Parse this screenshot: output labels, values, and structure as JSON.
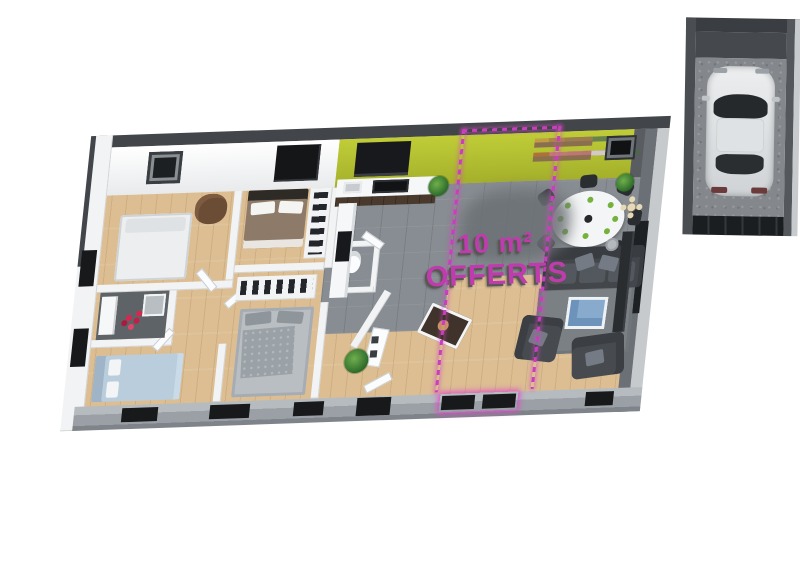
{
  "scene": {
    "description": "3D isometric floor plan render of a single-storey house with attached garage",
    "promo": {
      "line1": "10 m²",
      "line2": "OFFERTS"
    },
    "palette": {
      "background": "#ffffff",
      "accent_magenta": "#c23cb0",
      "feature_wall_green": "#aebd3a",
      "wood_floor": "#dcbe92",
      "tile_floor": "#878d92",
      "wall_dark": "#42464a",
      "wall_white": "#f2f3f4",
      "sofa_gray": "#474b50",
      "coffee_table_blue": "#87aacd"
    },
    "objects": [
      "double-bed-white",
      "double-bed-brown",
      "double-bed-gray",
      "double-bed-blue",
      "armchair-brown",
      "wardrobe-clothes",
      "bathroom-red-petals",
      "kitchen-counter",
      "kitchen-island",
      "dining-table-round",
      "dining-chairs",
      "wall-shelves",
      "picture-frames",
      "sofa",
      "living-armchairs",
      "coffee-table",
      "rug",
      "floor-lamp",
      "potted-plants",
      "car-top-view",
      "garage-door",
      "windows",
      "offer-zone-dashed-outline"
    ]
  }
}
